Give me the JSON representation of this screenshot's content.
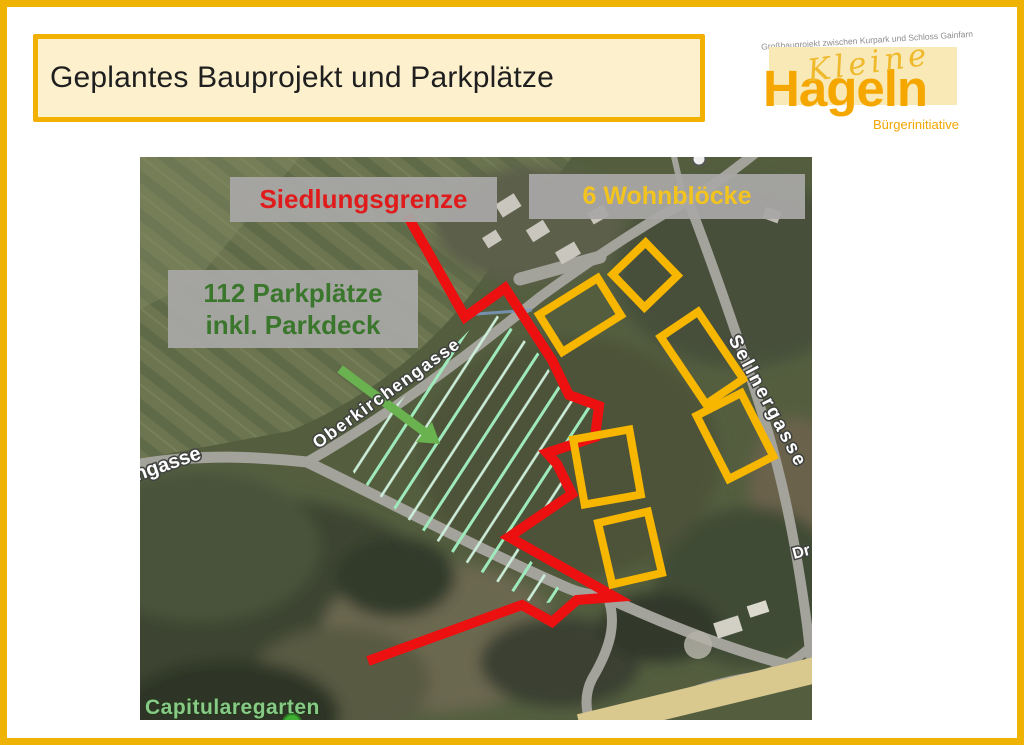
{
  "slide": {
    "title": "Geplantes Bauprojekt und Parkplätze"
  },
  "logo": {
    "tagline": "Großbauprojekt zwischen Kurpark und Schloss Gainfarn",
    "script_word": "Kleine",
    "main_word": "Hageln",
    "subtitle": "Bürgerinitiative"
  },
  "map": {
    "annotations": {
      "settlement_boundary": "Siedlungsgrenze",
      "apartment_blocks": "6 Wohnblöcke",
      "parking_line1": "112 Parkplätze",
      "parking_line2": "inkl. Parkdeck"
    },
    "streets": {
      "oberkirchengasse": "Oberkirchengasse",
      "sellnergasse": "Sellnergasse",
      "gasse_partial": "ngasse",
      "dr_partial": "Dr"
    },
    "places": {
      "park_label": "Capitularegarten"
    },
    "features": {
      "wohnblock_count": 6,
      "boundary_color": "#ec1010",
      "block_outline_color": "#f7b600",
      "hatch_color": "#9feabc",
      "arrow_color": "#69b24f",
      "label_background": "#a8a7a6"
    }
  }
}
